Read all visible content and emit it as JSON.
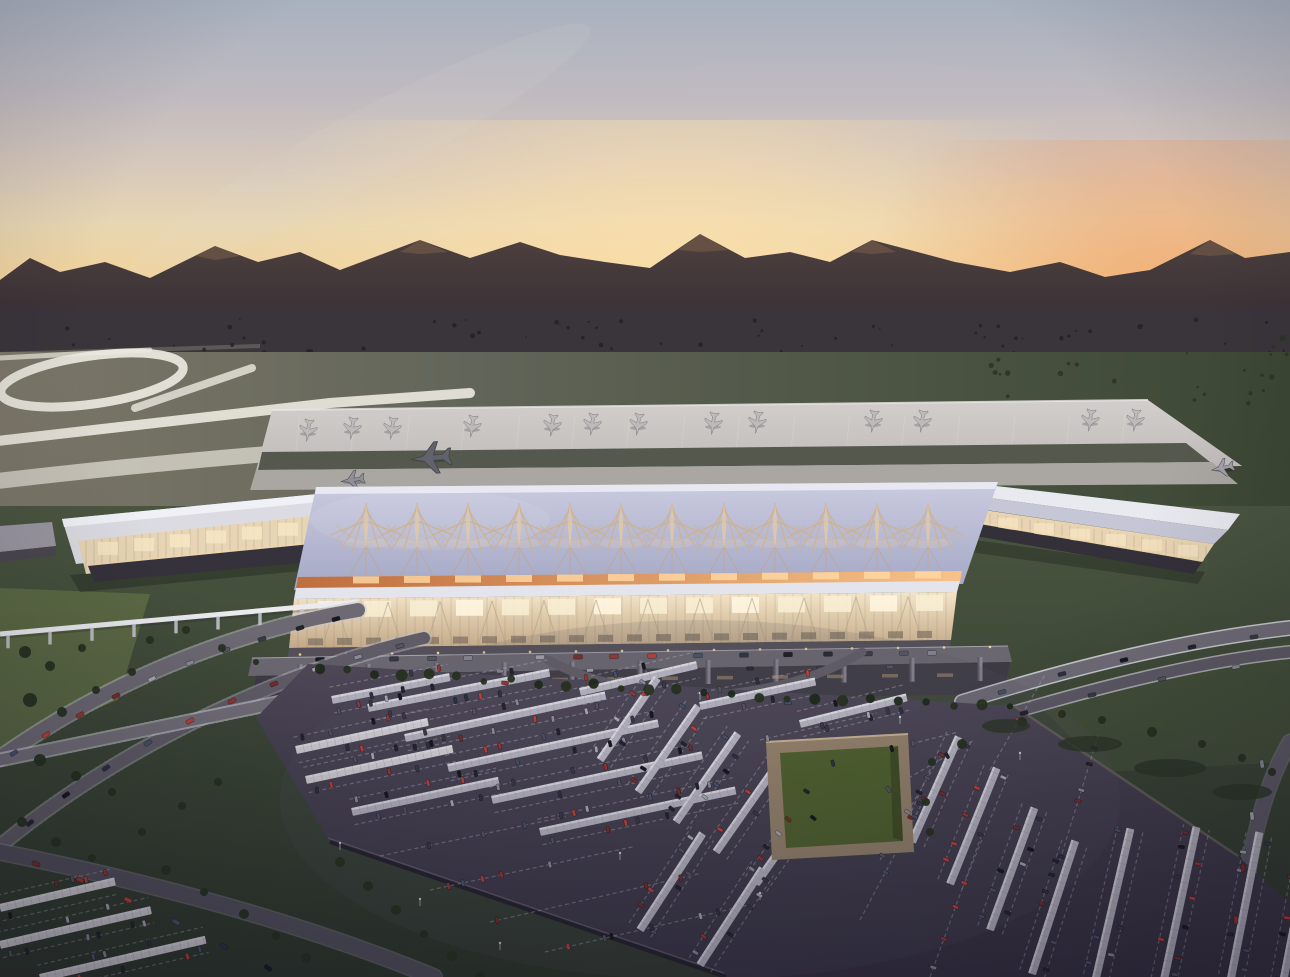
{
  "scene": {
    "description": "Aerial dusk architectural rendering of an airport: sunset sky over silhouetted mountains, runways and a large apron with parked jets, a terminal with a lattice-spire roof and glowing glass facade, looping access ramps, a people-mover track, and a vast solar-canopy parking lot with a sunken green courtyard.",
    "seed": 7,
    "counts": {
      "parked_aircraft": 13,
      "taxiing_aircraft": 4,
      "roof_spires": 12,
      "solar_canopies": 30,
      "distant_trees": 60
    }
  },
  "palette": {
    "sky_top": "#a8b1bf",
    "sky_mid": "#d6c8bc",
    "sky_horizon": "#efb77c",
    "sun_glow_left": "#ffe2ac",
    "sun_glow_right": "#f29c62",
    "mountain": "#4e403e",
    "plain": "#3a343b",
    "town_tree": "#241f27",
    "field_light": "#7c7769",
    "field_dark": "#3c4734",
    "runway_white": "#ece9e0",
    "apron": "#c9c4c2",
    "aircraft": "#bdbabb",
    "roof_lavender": "#b0b2cb",
    "spire_tan": "#cdb28f",
    "eave_orange": "#f7c289",
    "glass_glow": "#f2e3c6",
    "concourse_white": "#dcdbe2",
    "base_dark": "#35323b",
    "lawn": "#3e4936",
    "tree": "#26301f",
    "road": "#6e6a74",
    "rail_white": "#d2d2da",
    "monorail": "#ebebf0",
    "lot_asphalt": "#46404f",
    "canopy": "#b5b3bf",
    "canopy_bright": "#d4d0d6",
    "stall_line": "#b9b6c2",
    "courtyard_wall": "#93816a",
    "courtyard_lawn": "#4f612e",
    "car_colors": [
      "#17171f",
      "#24242e",
      "#3a3a46",
      "#555562",
      "#8c8c98",
      "#a9a9b4",
      "#7b2d28",
      "#9c3530",
      "#c04038",
      "#47536b",
      "#2c3242"
    ]
  },
  "geometry": {
    "parked_planes": [
      [
        308,
        431
      ],
      [
        352,
        429
      ],
      [
        392,
        429
      ],
      [
        472,
        427
      ],
      [
        552,
        426
      ],
      [
        592,
        425
      ],
      [
        638,
        425
      ],
      [
        713,
        424
      ],
      [
        757,
        423
      ],
      [
        873,
        422
      ],
      [
        922,
        422
      ],
      [
        1090,
        421
      ],
      [
        1135,
        421
      ]
    ],
    "taxi_planes": [
      [
        430,
        458,
        2.1,
        265,
        "#62626a"
      ],
      [
        352,
        480,
        1.25,
        262,
        "#8f8f96"
      ],
      [
        1222,
        468,
        1.2,
        258,
        "#a3a1aa"
      ],
      [
        80,
        523,
        1.05,
        205,
        "#55555e"
      ]
    ],
    "stand_line_x": [
      300,
      355,
      410,
      465,
      520,
      575,
      630,
      685,
      740,
      795,
      850,
      905,
      960,
      1015,
      1070,
      1125
    ],
    "spire_x": [
      366,
      417,
      468,
      519,
      570,
      621,
      672,
      724,
      775,
      826,
      877,
      928
    ],
    "spire_y": 529,
    "canopies": [
      [
        296,
        750,
        135,
        -12,
        1
      ],
      [
        306,
        780,
        150,
        -12,
        1
      ],
      [
        332,
        700,
        120,
        -11,
        0
      ],
      [
        368,
        708,
        185,
        -11,
        0
      ],
      [
        405,
        738,
        205,
        -12,
        0
      ],
      [
        448,
        768,
        215,
        -12,
        0
      ],
      [
        492,
        800,
        215,
        -12,
        0
      ],
      [
        540,
        832,
        200,
        -12,
        0
      ],
      [
        352,
        812,
        150,
        -12,
        0
      ],
      [
        580,
        692,
        120,
        -13,
        0
      ],
      [
        700,
        706,
        118,
        -12,
        0
      ],
      [
        800,
        724,
        110,
        -14,
        0
      ],
      [
        600,
        760,
        100,
        -55,
        0
      ],
      [
        638,
        792,
        105,
        -55,
        0
      ],
      [
        676,
        822,
        108,
        -55,
        0
      ],
      [
        716,
        852,
        108,
        -55,
        0
      ],
      [
        756,
        884,
        110,
        -55,
        0
      ],
      [
        640,
        930,
        115,
        -57,
        0
      ],
      [
        700,
        965,
        115,
        -57,
        0
      ],
      [
        912,
        842,
        115,
        -66,
        0
      ],
      [
        950,
        884,
        125,
        -68,
        0
      ],
      [
        990,
        930,
        130,
        -70,
        0
      ],
      [
        1032,
        974,
        140,
        -72,
        0
      ],
      [
        1090,
        1004,
        180,
        -77,
        0
      ],
      [
        1158,
        1008,
        185,
        -78,
        0
      ],
      [
        1226,
        1004,
        175,
        -79,
        0
      ],
      [
        1282,
        988,
        150,
        -79,
        0
      ],
      [
        0,
        908,
        118,
        -13,
        1
      ],
      [
        0,
        945,
        155,
        -13,
        1
      ],
      [
        40,
        978,
        170,
        -13,
        1
      ]
    ],
    "extra_dashes": [
      [
        380,
        856,
        190,
        -12
      ],
      [
        430,
        890,
        210,
        -12
      ],
      [
        490,
        922,
        215,
        -13
      ],
      [
        545,
        952,
        210,
        -13
      ],
      [
        830,
        764,
        130,
        -14
      ],
      [
        860,
        806,
        130,
        -30
      ],
      [
        880,
        860,
        120,
        -60
      ],
      [
        930,
        977,
        150,
        -70
      ],
      [
        1060,
        860,
        130,
        -73
      ],
      [
        760,
        740,
        120,
        -13
      ],
      [
        860,
        920,
        140,
        -62
      ],
      [
        990,
        770,
        110,
        -60
      ]
    ],
    "trees": [
      [
        25,
        652,
        6
      ],
      [
        50,
        666,
        5
      ],
      [
        82,
        648,
        4
      ],
      [
        30,
        700,
        7
      ],
      [
        62,
        712,
        5
      ],
      [
        96,
        690,
        4
      ],
      [
        132,
        672,
        4
      ],
      [
        150,
        640,
        4
      ],
      [
        186,
        630,
        4
      ],
      [
        222,
        648,
        4
      ],
      [
        256,
        662,
        3
      ],
      [
        40,
        760,
        6
      ],
      [
        76,
        776,
        5
      ],
      [
        112,
        792,
        4
      ],
      [
        22,
        822,
        5
      ],
      [
        56,
        842,
        5
      ],
      [
        92,
        858,
        4
      ],
      [
        142,
        832,
        4
      ],
      [
        182,
        806,
        4
      ],
      [
        218,
        782,
        4
      ],
      [
        166,
        870,
        5
      ],
      [
        204,
        892,
        4
      ],
      [
        244,
        914,
        5
      ],
      [
        276,
        936,
        4
      ],
      [
        306,
        958,
        5
      ],
      [
        340,
        862,
        5
      ],
      [
        368,
        886,
        5
      ],
      [
        396,
        910,
        5
      ],
      [
        424,
        934,
        4
      ],
      [
        452,
        956,
        5
      ],
      [
        480,
        977,
        5
      ],
      [
        1022,
        722,
        5
      ],
      [
        1062,
        714,
        4
      ],
      [
        1102,
        720,
        4
      ],
      [
        1152,
        732,
        5
      ],
      [
        1202,
        744,
        4
      ],
      [
        1242,
        758,
        4
      ],
      [
        1272,
        772,
        4
      ],
      [
        962,
        744,
        5
      ],
      [
        932,
        762,
        4
      ],
      [
        926,
        802,
        4
      ],
      [
        930,
        832,
        4
      ]
    ],
    "shrubs": [
      [
        1090,
        744,
        32,
        8
      ],
      [
        1170,
        768,
        36,
        9
      ],
      [
        1242,
        792,
        30,
        8
      ],
      [
        1006,
        726,
        24,
        7
      ]
    ],
    "hedge_curve": [
      [
        320,
        668
      ],
      [
        660,
        692
      ],
      [
        1010,
        708
      ]
    ],
    "road_a_cars": [
      [
        336,
        619,
        -16
      ],
      [
        300,
        628,
        -17
      ],
      [
        262,
        639,
        -18
      ],
      [
        226,
        650,
        -20
      ],
      [
        190,
        663,
        -22
      ],
      [
        152,
        679,
        -25
      ],
      [
        116,
        696,
        -27
      ],
      [
        80,
        715,
        -29
      ],
      [
        46,
        735,
        -31
      ],
      [
        14,
        753,
        -33
      ]
    ],
    "road_b_cars": [
      [
        400,
        646,
        -15
      ],
      [
        358,
        657,
        -17
      ],
      [
        316,
        669,
        -19
      ],
      [
        274,
        684,
        -22
      ],
      [
        232,
        701,
        -25
      ],
      [
        190,
        721,
        -28
      ],
      [
        148,
        743,
        -31
      ],
      [
        106,
        768,
        -33
      ],
      [
        66,
        795,
        -35
      ],
      [
        30,
        823,
        -37
      ]
    ],
    "road_c_cars": [
      [
        36,
        864,
        22
      ],
      [
        80,
        880,
        24
      ],
      [
        128,
        900,
        26
      ],
      [
        176,
        922,
        28
      ],
      [
        224,
        946,
        30
      ],
      [
        268,
        968,
        32
      ]
    ],
    "hwy1_cars": [
      [
        1002,
        692,
        -14
      ],
      [
        1062,
        674,
        -14
      ],
      [
        1124,
        660,
        -13
      ],
      [
        1192,
        647,
        -12
      ],
      [
        1254,
        637,
        -10
      ]
    ],
    "hwy2_cars": [
      [
        1024,
        713,
        -13
      ],
      [
        1092,
        695,
        -13
      ],
      [
        1162,
        679,
        -12
      ],
      [
        1236,
        667,
        -11
      ]
    ],
    "right_road_cars": [
      [
        1262,
        764,
        82
      ],
      [
        1252,
        816,
        84
      ],
      [
        1243,
        868,
        86
      ],
      [
        1236,
        920,
        88
      ]
    ],
    "perimeter_cars": [
      [
        505,
        683,
        5
      ],
      [
        645,
        694,
        4
      ],
      [
        788,
        703,
        3
      ]
    ],
    "curb_car_x": [
      320,
      358,
      394,
      432,
      468,
      540,
      578,
      614,
      652,
      698,
      744,
      788,
      828,
      868,
      904,
      932
    ],
    "lower_car_x": [
      350,
      420,
      500,
      590,
      670,
      750,
      820,
      890
    ],
    "monorail": {
      "x1": 0,
      "y1": 634,
      "x2": 358,
      "y2": 602,
      "pier_step": 42
    },
    "lamp_posts": [
      [
        340,
        850
      ],
      [
        420,
        906
      ],
      [
        500,
        950
      ],
      [
        700,
        700
      ],
      [
        900,
        724
      ],
      [
        1020,
        760
      ],
      [
        620,
        860
      ],
      [
        760,
        900
      ]
    ]
  }
}
